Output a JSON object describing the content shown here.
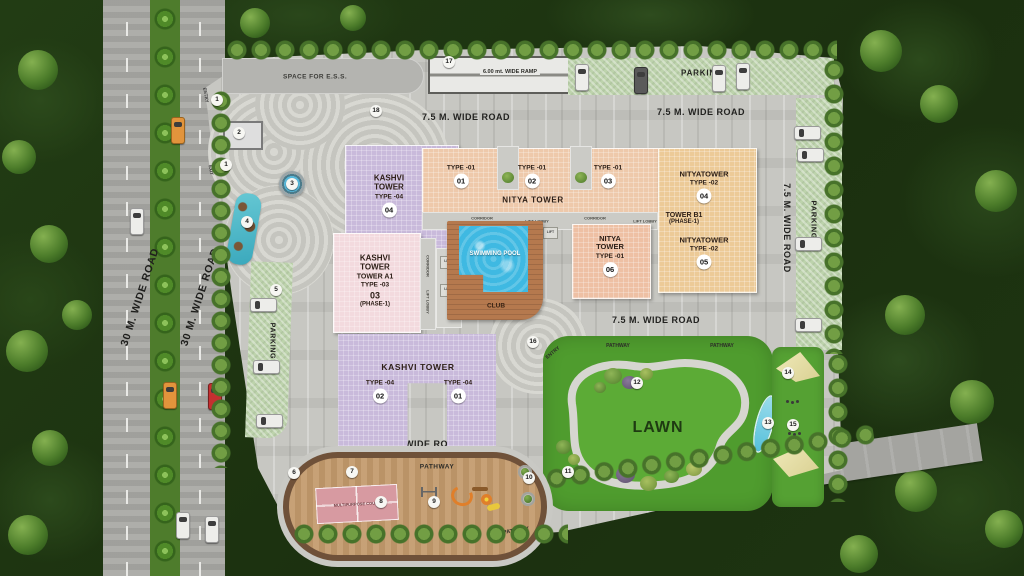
{
  "scene": {
    "name": "residential site master plan"
  },
  "roads": {
    "thirty": "30 M. WIDE ROAD",
    "seven_five": "7.5 M. WIDE ROAD",
    "nine": "9M. WIDE ROAD",
    "ramp": "6.00 mt. WIDE RAMP"
  },
  "areas": {
    "parking": "PARKING",
    "entry": "ENTRY",
    "exit": "EXIT",
    "pathway": "PATHWAY",
    "lawn": "LAWN",
    "ess": "SPACE FOR E.S.S.",
    "pool": "SWIMMING POOL",
    "club": "CLUB",
    "court": "MULTIPURPOSE COURT"
  },
  "cores": {
    "corridor": "CORRIDOR",
    "lift_lobby": "LIFT LOBBY",
    "lift": "LIFT"
  },
  "towers": {
    "kashvi_top": {
      "name": "KASHVI TOWER",
      "type": "TYPE -04",
      "unit": "04"
    },
    "nitya": {
      "name": "NITYA TOWER",
      "wings": [
        {
          "type": "TYPE -01",
          "unit": "01"
        },
        {
          "type": "TYPE -01",
          "unit": "02"
        },
        {
          "type": "TYPE -01",
          "unit": "03"
        }
      ]
    },
    "nityatower_04": {
      "name": "NITYATOWER",
      "type": "TYPE -02",
      "unit": "04"
    },
    "tower_b1": {
      "name": "TOWER B1",
      "phase": "(PHASE-1)"
    },
    "nityatower_05": {
      "name": "NITYATOWER",
      "type": "TYPE -02",
      "unit": "05"
    },
    "kashvi_a1": {
      "name": "KASHVI TOWER",
      "tower": "TOWER A1",
      "type": "TYPE -03",
      "unit": "03",
      "phase": "(PHASE-1)"
    },
    "nitya_06": {
      "name": "NITYA TOWER",
      "type": "TYPE -01",
      "unit": "06"
    },
    "kashvi_bottom": {
      "name": "KASHVI TOWER",
      "wings": [
        {
          "type": "TYPE -04",
          "unit": "02"
        },
        {
          "type": "TYPE -04",
          "unit": "01"
        }
      ]
    }
  },
  "colors": {
    "kashvi_purple": "#c9badb",
    "nitya_peach": "#eec9ab",
    "nityatower_tan": "#ecca97",
    "kashvi_pink": "#f3dade",
    "pool_blue": "#3fb9e2",
    "club_brown": "#b5794e",
    "lawn_green": "#54a232",
    "parking_green": "#bcd4ab",
    "paving_grey": "#c7c7c2",
    "forest_green": "#203913"
  },
  "markers": [
    {
      "n": "1",
      "x": 217,
      "y": 100
    },
    {
      "n": "2",
      "x": 239,
      "y": 133
    },
    {
      "n": "1",
      "x": 226,
      "y": 165
    },
    {
      "n": "3",
      "x": 292,
      "y": 184
    },
    {
      "n": "4",
      "x": 247,
      "y": 222
    },
    {
      "n": "5",
      "x": 276,
      "y": 290
    },
    {
      "n": "6",
      "x": 294,
      "y": 473
    },
    {
      "n": "7",
      "x": 352,
      "y": 472
    },
    {
      "n": "8",
      "x": 381,
      "y": 502
    },
    {
      "n": "9",
      "x": 434,
      "y": 502
    },
    {
      "n": "10",
      "x": 529,
      "y": 478
    },
    {
      "n": "11",
      "x": 568,
      "y": 472
    },
    {
      "n": "12",
      "x": 637,
      "y": 383
    },
    {
      "n": "13",
      "x": 768,
      "y": 423
    },
    {
      "n": "14",
      "x": 788,
      "y": 373
    },
    {
      "n": "15",
      "x": 793,
      "y": 425
    },
    {
      "n": "16",
      "x": 533,
      "y": 342
    },
    {
      "n": "17",
      "x": 449,
      "y": 62
    },
    {
      "n": "18",
      "x": 376,
      "y": 111
    }
  ]
}
